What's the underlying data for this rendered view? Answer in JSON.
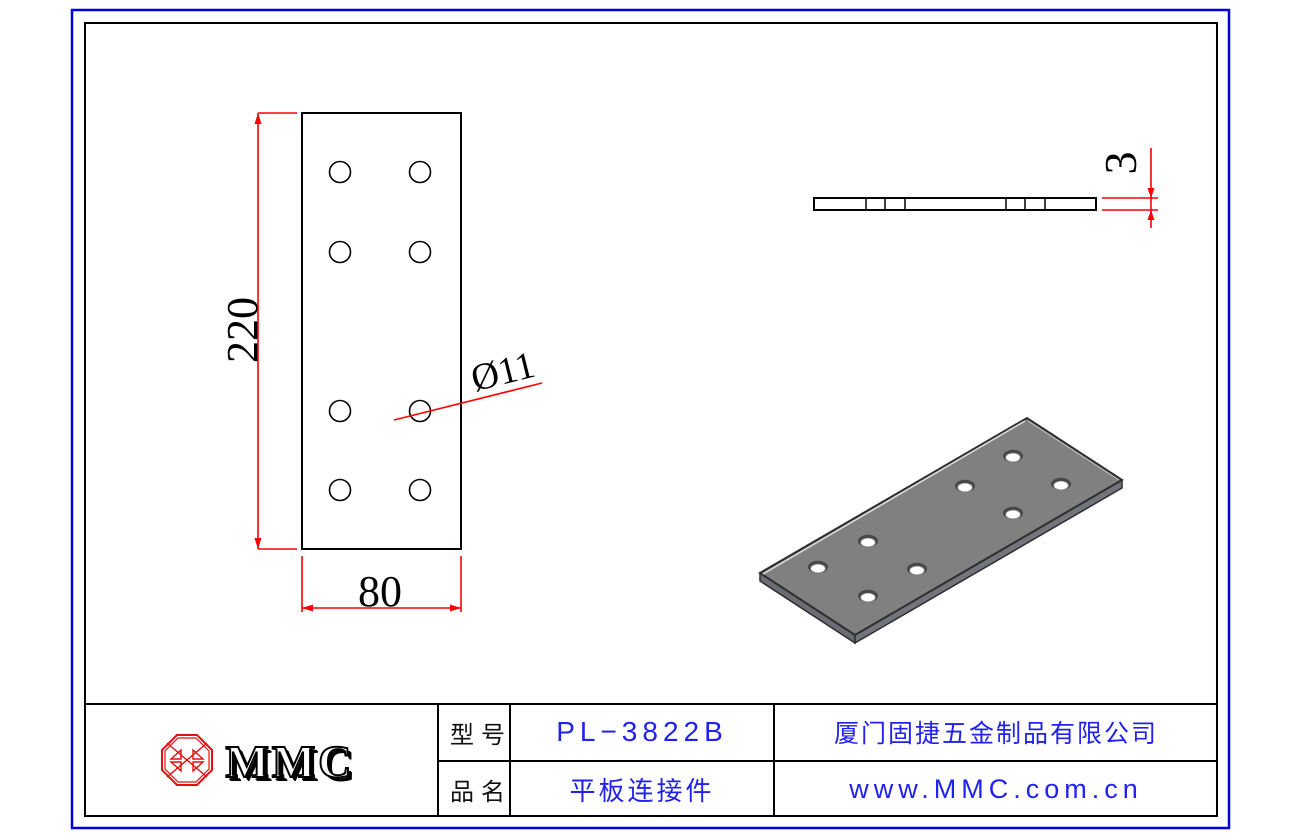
{
  "sheet": {
    "outer_border_color": "#0000dd",
    "inner_border_color": "#000000",
    "background": "#ffffff"
  },
  "views": {
    "front_view": {
      "dim_length": "220",
      "dim_width": "80",
      "hole_callout": "Ø11",
      "hole_count": 8,
      "dimension_color": "#ff0000",
      "line_color": "#000000"
    },
    "side_view": {
      "dim_thickness": "3",
      "dimension_color": "#ff0000"
    },
    "iso_view": {
      "body_color": "#808080",
      "side_color": "#70707a",
      "edge_color": "#2e2e2e",
      "hole_count": 8
    }
  },
  "title_block": {
    "logo_text": "MMC",
    "logo_icon": "mmc-octagon-logo",
    "logo_color": "#e01010",
    "model_label": "型号",
    "model_value": "PL−3822B",
    "name_label": "品名",
    "name_value": "平板连接件",
    "company": "厦门固捷五金制品有限公司",
    "website": "www.MMC.com.cn",
    "text_color": "#2222ee"
  }
}
